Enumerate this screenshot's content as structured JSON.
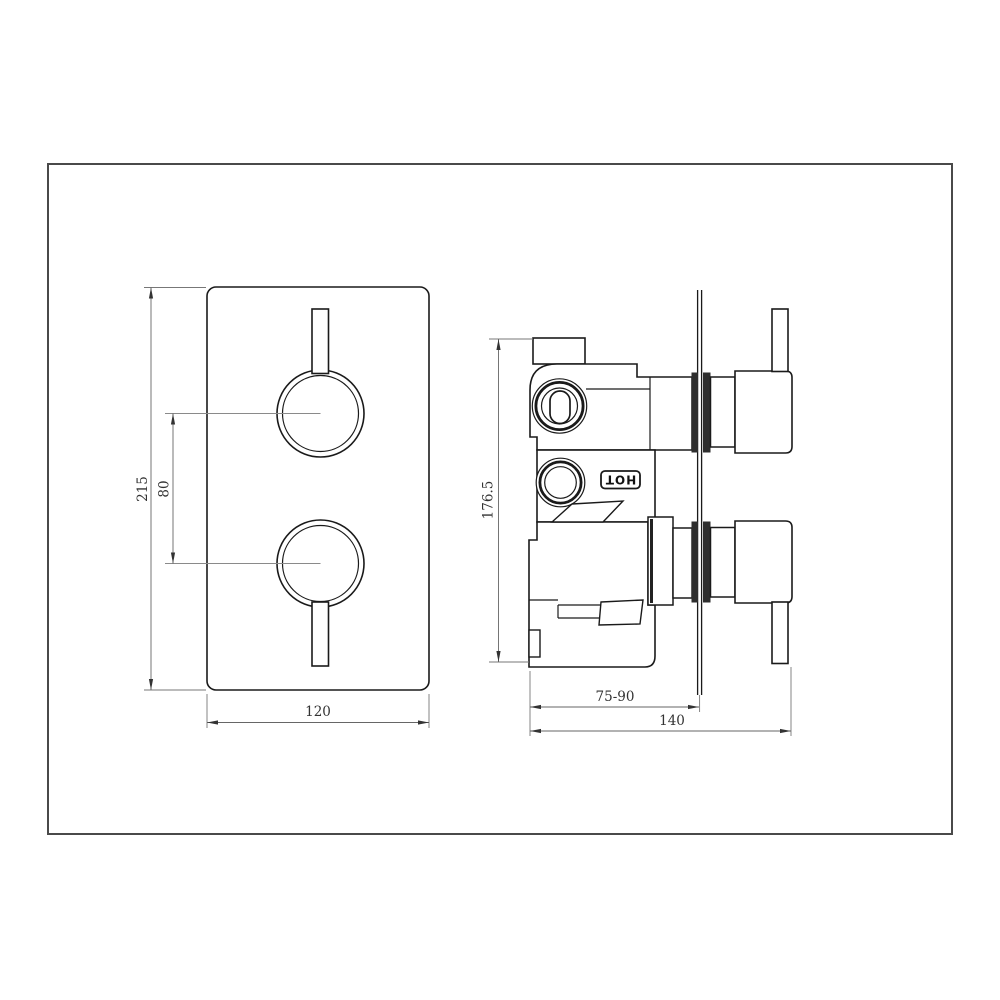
{
  "drawing": {
    "front_view": {
      "height_dim": "215",
      "center_spacing_dim": "80",
      "width_dim": "120"
    },
    "side_view": {
      "height_dim": "176.5",
      "recess_depth_dim": "75-90",
      "total_depth_dim": "140",
      "hot_label": "HOT"
    },
    "colors": {
      "line": "#1a1a1a",
      "border": "#4a4a4a",
      "background": "#ffffff"
    }
  }
}
